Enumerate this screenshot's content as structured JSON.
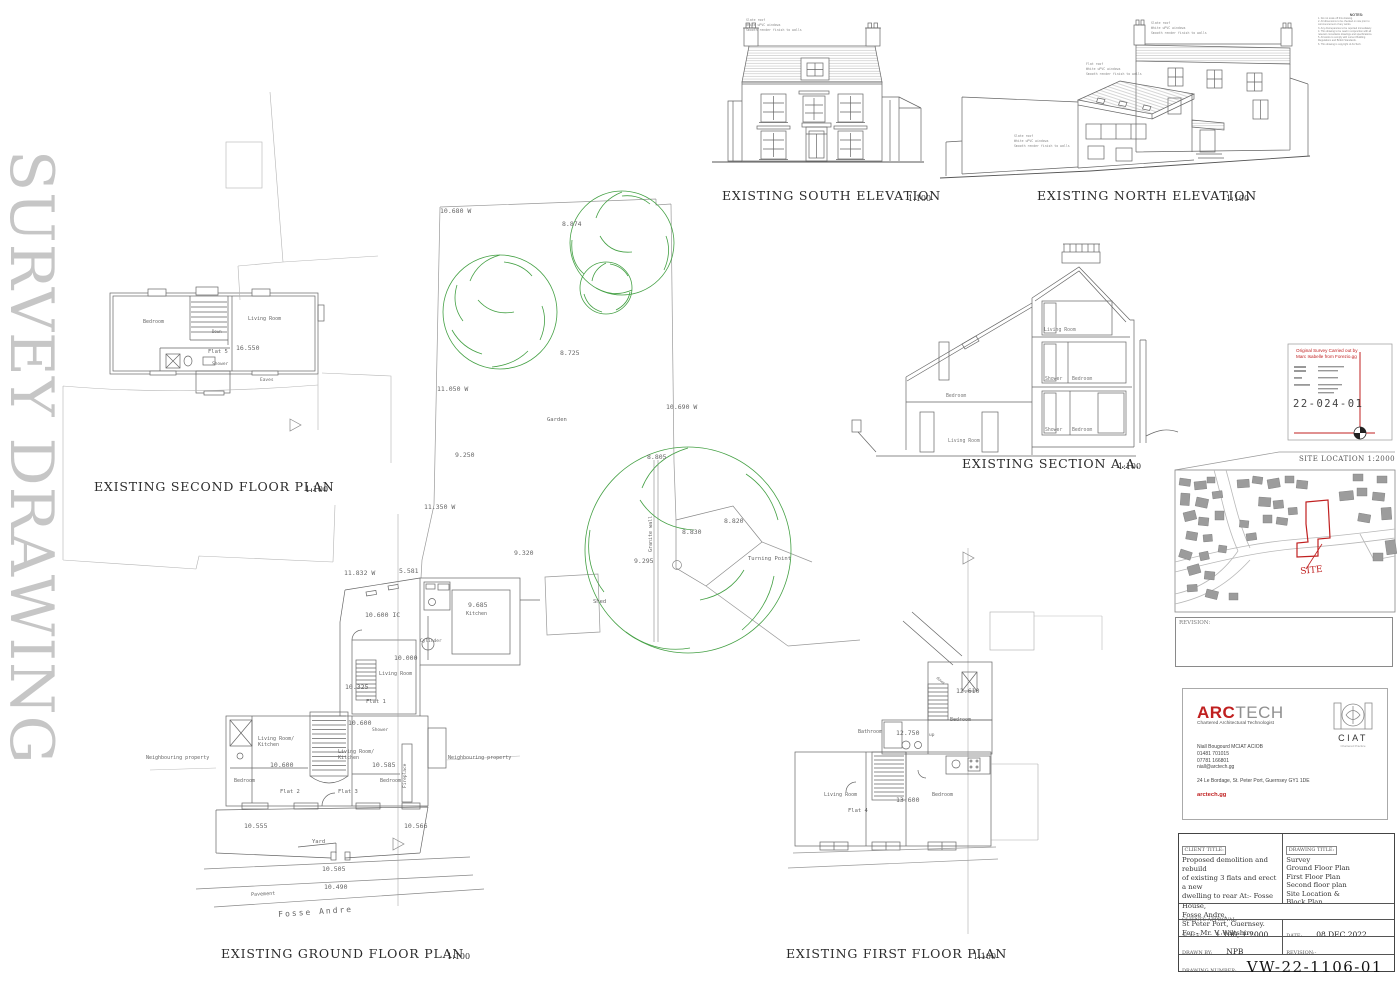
{
  "sheet": {
    "watermark": "SURVEY DRAWING"
  },
  "colors": {
    "accent_red": "#c02020",
    "tree_green": "#44a044",
    "line_gray": "#666666",
    "watermark_gray": "#c6c6c6"
  },
  "annotations": {
    "titles": [
      {
        "t": "EXISTING SOUTH ELEVATION",
        "x": 722,
        "y": 190,
        "s": 12.5,
        "f": "h",
        "c": "#2b2b2b",
        "ls": 0.8,
        "n": "title-south-elevation"
      },
      {
        "t": "1:100",
        "x": 908,
        "y": 195,
        "s": 8,
        "f": "h",
        "c": "#2b2b2b",
        "n": "scale-south-elevation"
      },
      {
        "t": "EXISTING NORTH ELEVATION",
        "x": 1037,
        "y": 190,
        "s": 12.5,
        "f": "h",
        "c": "#2b2b2b",
        "ls": 0.8,
        "n": "title-north-elevation"
      },
      {
        "t": "1:100",
        "x": 1226,
        "y": 195,
        "s": 8,
        "f": "h",
        "c": "#2b2b2b",
        "n": "scale-north-elevation"
      },
      {
        "t": "EXISTING SECTION A.A.",
        "x": 962,
        "y": 458,
        "s": 12.5,
        "f": "h",
        "c": "#2b2b2b",
        "ls": 0.8,
        "n": "title-section-aa"
      },
      {
        "t": "1:100",
        "x": 1118,
        "y": 463,
        "s": 8,
        "f": "h",
        "c": "#2b2b2b",
        "n": "scale-section-aa"
      },
      {
        "t": "EXISTING  SECOND FLOOR PLAN",
        "x": 94,
        "y": 481,
        "s": 12.5,
        "f": "h",
        "c": "#2b2b2b",
        "ls": 0.8,
        "n": "title-second-floor-plan"
      },
      {
        "t": "1:100",
        "x": 305,
        "y": 486,
        "s": 8,
        "f": "h",
        "c": "#2b2b2b",
        "n": "scale-second-floor-plan"
      },
      {
        "t": "EXISTING  GROUND FLOOR PLAN",
        "x": 221,
        "y": 948,
        "s": 12.5,
        "f": "h",
        "c": "#2b2b2b",
        "ls": 0.8,
        "n": "title-ground-floor-plan"
      },
      {
        "t": "1:100",
        "x": 447,
        "y": 953,
        "s": 8,
        "f": "h",
        "c": "#2b2b2b",
        "n": "scale-ground-floor-plan"
      },
      {
        "t": "EXISTING FIRST FLOOR PLAN",
        "x": 786,
        "y": 948,
        "s": 12.5,
        "f": "h",
        "c": "#2b2b2b",
        "ls": 0.8,
        "n": "title-first-floor-plan"
      },
      {
        "t": "1:100",
        "x": 973,
        "y": 953,
        "s": 8,
        "f": "h",
        "c": "#2b2b2b",
        "n": "scale-first-floor-plan"
      }
    ],
    "garden": [
      {
        "t": "10.680 W",
        "x": 440,
        "y": 208
      },
      {
        "t": "8.874",
        "x": 562,
        "y": 221
      },
      {
        "t": "8.725",
        "x": 560,
        "y": 350
      },
      {
        "t": "11.050 W",
        "x": 437,
        "y": 386
      },
      {
        "t": "10.690 W",
        "x": 666,
        "y": 404
      },
      {
        "t": "9.250",
        "x": 455,
        "y": 452
      },
      {
        "t": "11.350 W",
        "x": 424,
        "y": 504
      },
      {
        "t": "8.805",
        "x": 647,
        "y": 454
      },
      {
        "t": "9.320",
        "x": 514,
        "y": 550
      },
      {
        "t": "9.295",
        "x": 634,
        "y": 558
      },
      {
        "t": "8.830",
        "x": 682,
        "y": 529
      },
      {
        "t": "8.820",
        "x": 724,
        "y": 518
      },
      {
        "t": "Garden",
        "x": 547,
        "y": 418,
        "s": 5.5
      },
      {
        "t": "Shed",
        "x": 593,
        "y": 600,
        "s": 5.5
      },
      {
        "t": "Turning Point",
        "x": 748,
        "y": 557,
        "s": 5.5
      },
      {
        "t": "Granite wall",
        "x": 649,
        "y": 552,
        "s": 5,
        "r": -90
      }
    ],
    "ground_floor": [
      {
        "t": "11.832 W",
        "x": 344,
        "y": 570
      },
      {
        "t": "5.581",
        "x": 399,
        "y": 568
      },
      {
        "t": "10.600 IC",
        "x": 365,
        "y": 612
      },
      {
        "t": "9.685",
        "x": 468,
        "y": 602
      },
      {
        "t": "Kitchen",
        "x": 466,
        "y": 612,
        "s": 5
      },
      {
        "t": "Cylinder",
        "x": 420,
        "y": 640,
        "s": 4.5
      },
      {
        "t": "10.000",
        "x": 394,
        "y": 655
      },
      {
        "t": "Living Room",
        "x": 379,
        "y": 672,
        "s": 5
      },
      {
        "t": "10.325",
        "x": 345,
        "y": 684
      },
      {
        "t": "Flat 1",
        "x": 366,
        "y": 700,
        "s": 5.5
      },
      {
        "t": "10.600",
        "x": 348,
        "y": 720
      },
      {
        "t": "Shower",
        "x": 372,
        "y": 729,
        "s": 4.5
      },
      {
        "t": "Living Room/",
        "x": 258,
        "y": 737,
        "s": 5
      },
      {
        "t": "Kitchen",
        "x": 258,
        "y": 743,
        "s": 5
      },
      {
        "t": "10.600",
        "x": 270,
        "y": 762
      },
      {
        "t": "Living Room/",
        "x": 338,
        "y": 750,
        "s": 5
      },
      {
        "t": "Kitchen",
        "x": 338,
        "y": 756,
        "s": 5
      },
      {
        "t": "10.585",
        "x": 372,
        "y": 762
      },
      {
        "t": "Bedroom",
        "x": 234,
        "y": 779,
        "s": 5
      },
      {
        "t": "Flat 2",
        "x": 280,
        "y": 790,
        "s": 5.5
      },
      {
        "t": "Flat 3",
        "x": 338,
        "y": 790,
        "s": 5.5
      },
      {
        "t": "Bedroom",
        "x": 380,
        "y": 779,
        "s": 5
      },
      {
        "t": "Fireplace",
        "x": 404,
        "y": 788,
        "s": 4.5,
        "r": -90
      },
      {
        "t": "Neighbouring property",
        "x": 146,
        "y": 756,
        "s": 5
      },
      {
        "t": "Neighbouring property",
        "x": 448,
        "y": 756,
        "s": 5
      },
      {
        "t": "10.555",
        "x": 244,
        "y": 823
      },
      {
        "t": "10.566",
        "x": 404,
        "y": 823
      },
      {
        "t": "Yard",
        "x": 312,
        "y": 840,
        "s": 5.5
      },
      {
        "t": "10.505",
        "x": 322,
        "y": 866
      },
      {
        "t": "10.490",
        "x": 324,
        "y": 884
      },
      {
        "t": "Pavement",
        "x": 251,
        "y": 893,
        "s": 5,
        "r": -3
      },
      {
        "t": "Fosse Andre",
        "x": 278,
        "y": 911,
        "s": 8,
        "r": -4,
        "ls": 2
      }
    ],
    "second_floor": [
      {
        "t": "Bedroom",
        "x": 143,
        "y": 320,
        "s": 5
      },
      {
        "t": "Living Room",
        "x": 248,
        "y": 317,
        "s": 5
      },
      {
        "t": "16.550",
        "x": 236,
        "y": 345,
        "s": 6.5
      },
      {
        "t": "Flat 5",
        "x": 208,
        "y": 350,
        "s": 5.5
      },
      {
        "t": "Shower",
        "x": 212,
        "y": 363,
        "s": 4.5
      },
      {
        "t": "Eaves",
        "x": 260,
        "y": 379,
        "s": 4.5
      },
      {
        "t": "Down",
        "x": 212,
        "y": 330,
        "s": 4
      }
    ],
    "first_floor": [
      {
        "t": "down",
        "x": 938,
        "y": 676,
        "s": 4,
        "r": 40
      },
      {
        "t": "12.610",
        "x": 956,
        "y": 688
      },
      {
        "t": "Bedroom",
        "x": 950,
        "y": 718,
        "s": 5
      },
      {
        "t": "Bathroom",
        "x": 858,
        "y": 730,
        "s": 5
      },
      {
        "t": "12.750",
        "x": 896,
        "y": 730
      },
      {
        "t": "up",
        "x": 929,
        "y": 734,
        "s": 4.5
      },
      {
        "t": "Living Room",
        "x": 824,
        "y": 793,
        "s": 5
      },
      {
        "t": "Flat 4",
        "x": 848,
        "y": 809,
        "s": 5.5
      },
      {
        "t": "13.600",
        "x": 896,
        "y": 797
      },
      {
        "t": "Bedroom",
        "x": 932,
        "y": 793,
        "s": 5
      }
    ],
    "section": [
      {
        "t": "Living Room",
        "x": 1044,
        "y": 329,
        "s": 4.8,
        "c": "#777777"
      },
      {
        "t": "Shower",
        "x": 1045,
        "y": 378,
        "s": 4.8,
        "c": "#777777"
      },
      {
        "t": "Bedroom",
        "x": 1072,
        "y": 378,
        "s": 4.8,
        "c": "#777777"
      },
      {
        "t": "Shower",
        "x": 1045,
        "y": 429,
        "s": 4.8,
        "c": "#777777"
      },
      {
        "t": "Bedroom",
        "x": 1072,
        "y": 429,
        "s": 4.8,
        "c": "#777777"
      },
      {
        "t": "Bedroom",
        "x": 946,
        "y": 395,
        "s": 4.8,
        "c": "#777777"
      },
      {
        "t": "Living Room",
        "x": 948,
        "y": 440,
        "s": 4.8,
        "c": "#777777"
      }
    ],
    "elevation_notes": [
      {
        "t": "Slate roof",
        "x": 746,
        "y": 19,
        "s": 3.2,
        "c": "#888888"
      },
      {
        "t": "White uPVC windows",
        "x": 746,
        "y": 24,
        "s": 3.2,
        "c": "#888888"
      },
      {
        "t": "Smooth render finish to walls",
        "x": 746,
        "y": 29,
        "s": 3.2,
        "c": "#888888"
      },
      {
        "t": "Slate roof",
        "x": 1151,
        "y": 22,
        "s": 3.2,
        "c": "#888888"
      },
      {
        "t": "White uPVC windows",
        "x": 1151,
        "y": 27,
        "s": 3.2,
        "c": "#888888"
      },
      {
        "t": "Smooth render finish to walls",
        "x": 1151,
        "y": 32,
        "s": 3.2,
        "c": "#888888"
      },
      {
        "t": "Flat roof",
        "x": 1086,
        "y": 63,
        "s": 3.2,
        "c": "#888888"
      },
      {
        "t": "White uPVC windows",
        "x": 1086,
        "y": 68,
        "s": 3.2,
        "c": "#888888"
      },
      {
        "t": "Smooth render finish to walls",
        "x": 1086,
        "y": 73,
        "s": 3.2,
        "c": "#888888"
      },
      {
        "t": "Slate roof",
        "x": 1014,
        "y": 135,
        "s": 3.2,
        "c": "#888888"
      },
      {
        "t": "White uPVC windows",
        "x": 1014,
        "y": 140,
        "s": 3.2,
        "c": "#888888"
      },
      {
        "t": "Smooth render finish to walls",
        "x": 1014,
        "y": 145,
        "s": 3.2,
        "c": "#888888"
      }
    ],
    "map": [
      {
        "t": "SITE LOCATION 1:2000",
        "x": 1299,
        "y": 456,
        "s": 7,
        "f": "h",
        "c": "#555555",
        "ls": 0.5,
        "n": "site-location-title"
      },
      {
        "t": "SITE",
        "x": 1300,
        "y": 568,
        "s": 9,
        "f": "h",
        "c": "#c02020",
        "r": -6,
        "n": "site-marker-label"
      }
    ],
    "stamp": [
      {
        "t": "Original Survey Carried out by",
        "x": 1296,
        "y": 349,
        "s": 4.6,
        "f": "s",
        "c": "#c02020"
      },
      {
        "t": "Marc Isabelle from Forezio.gg",
        "x": 1296,
        "y": 355,
        "s": 4.6,
        "f": "s",
        "c": "#c02020"
      },
      {
        "t": "22-024-01",
        "x": 1293,
        "y": 399,
        "s": 10.5,
        "ls": 1.5,
        "c": "#444444",
        "n": "survey-number"
      }
    ]
  },
  "revision_box": {
    "label": "REVISION:"
  },
  "arctech": {
    "brand_arc": "ARC",
    "brand_tech": "TECH",
    "tagline": "Chartered Architectural Technologist",
    "contact_lines": [
      "Niall Bougourd MCIAT  ACIOB",
      "01481 701015",
      "07781 166801",
      "niall@arctech.gg"
    ],
    "address": "24 Le Bordage, St. Peter Port, Guernsey GY1 1DE",
    "website": "arctech.gg",
    "ciat": "CIAT",
    "ciat_sub": "Chartered Practice"
  },
  "title_block": {
    "client_title_label": "CLIENT TITLE:",
    "client_lines": [
      "Proposed demolition and rebuild",
      "of existing 3 flats and erect a new",
      "dwelling to rear At:- Fosse House,",
      "Fosse Andre,",
      "St Peter Port, Guernsey.",
      "For:- Mr. V. Wiltshire."
    ],
    "drawing_title_label": "DRAWING TITLE:",
    "drawing_lines": [
      "Survey",
      "Ground Floor Plan",
      "First Floor Plan",
      "Second floor plan",
      "Site Location &",
      "Block Plan"
    ],
    "clients_approval_label": "CLIENTS APPROVAL:",
    "scale_label": "SCALE:",
    "scale_value": "1:100, 1:2000",
    "date_label": "DATE:",
    "date_value": "08 DEC 2022",
    "drawn_by_label": "DRAWN BY:",
    "drawn_by_value": "NPB",
    "revision_label": "REVISION:-",
    "drawing_number_label": "DRAWING NUMBER:",
    "drawing_number": "VW-22-1106-01"
  },
  "notes": {
    "heading": "NOTES:",
    "lines": [
      "1. Do not scale off this drawing.",
      "2. All dimensions to be checked on site prior to",
      "commencement of any works.",
      "3. Any discrepancies to be reported immediately.",
      "4. This drawing to be read in conjunction with all",
      "relevant consultants drawings and specifications.",
      "5. All works to comply with current Building",
      "Regulations and British Standards.",
      "6. This drawing is copyright of ArcTech."
    ]
  }
}
